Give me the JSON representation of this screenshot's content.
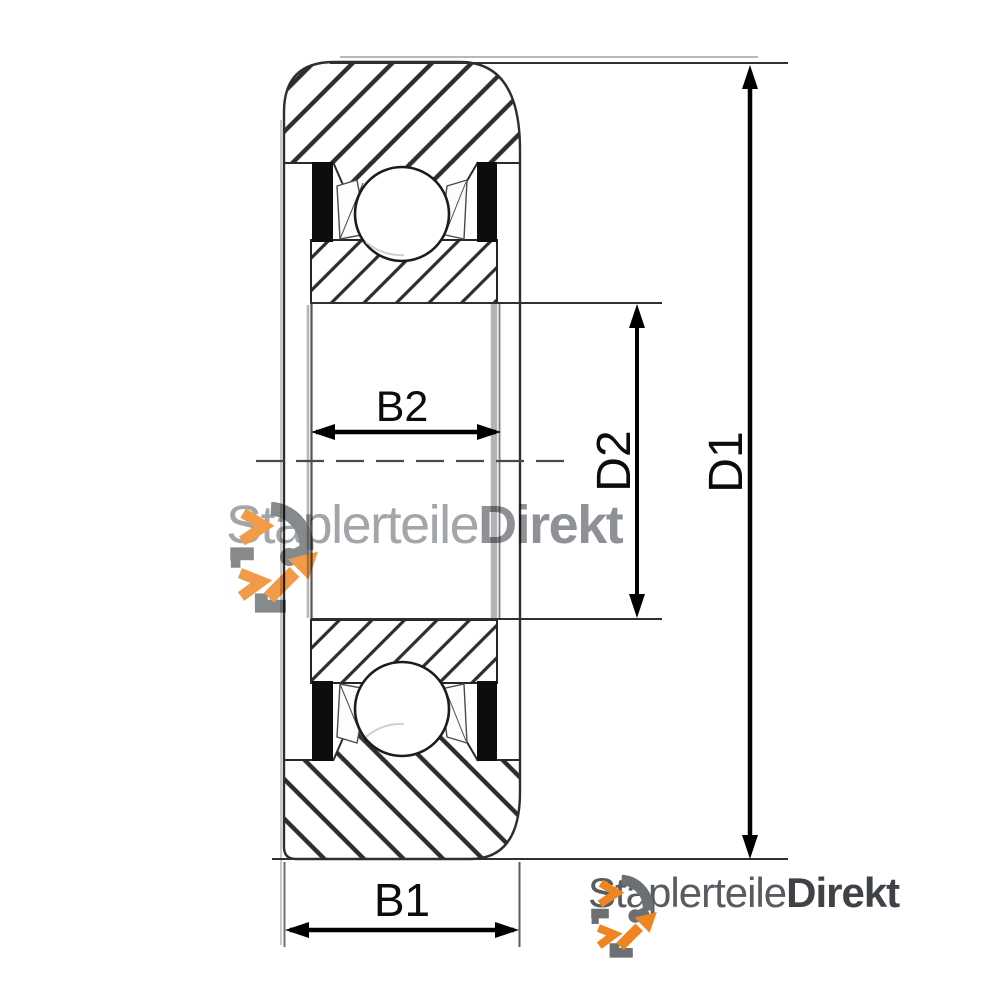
{
  "canvas": {
    "width": 1000,
    "height": 1000,
    "background": "#ffffff"
  },
  "diagram": {
    "type": "bearing-cross-section-technical-drawing",
    "labels": {
      "b1": "B1",
      "b2": "B2",
      "d1": "D1",
      "d2": "D2"
    },
    "colors": {
      "outline": "#2e2e2e",
      "hatch": "#2d2d2d",
      "seal": "#0d0d0d",
      "dimension": "#000000",
      "centerline": "#4a4a4a",
      "extension": "#2f2f2f"
    }
  },
  "watermark": {
    "icon": "rotation-arrows-icon",
    "text_regular": "Staplerteile",
    "text_bold": "Direkt"
  },
  "footer_logo": {
    "icon": "rotation-arrows-icon",
    "text_regular": "Staplerteile",
    "text_bold": "Direkt",
    "colors": {
      "orange": "#ee8520",
      "gray": "#6d7073"
    }
  }
}
